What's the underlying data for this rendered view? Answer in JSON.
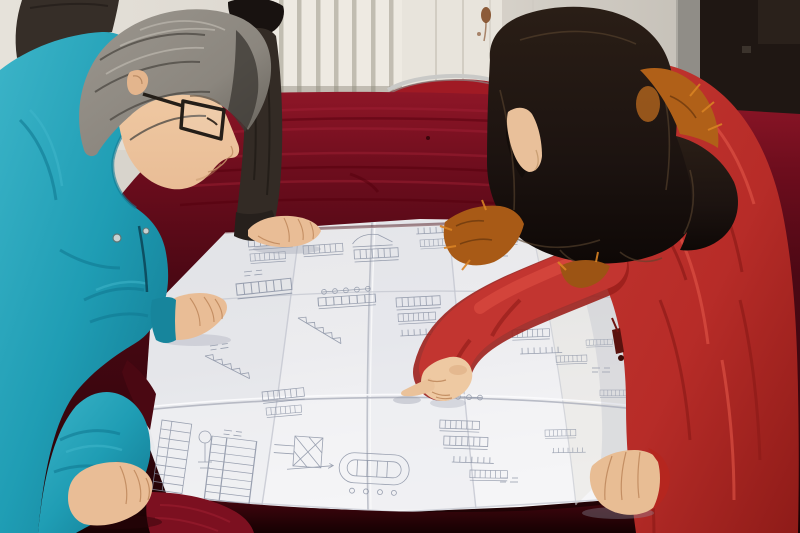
{
  "scene": {
    "type": "photograph",
    "alt": "Two workers lean over a large folded engineering blueprint spread on a dark crimson velvet-covered table. A gray-haired man in a teal work jacket and dark glasses studies the drawing from the left; a woman with long dark hair in a bright red parka with an orange fur-trimmed hood points at a detail. A third person in a dark jacket rests a hand on the far edge of the sheet.",
    "people": [
      {
        "label": "man in teal work jacket with glasses"
      },
      {
        "label": "person in dark jacket resting hand on drawing"
      },
      {
        "label": "woman in red fur-trimmed parka pointing at drawing"
      }
    ],
    "objects": [
      {
        "label": "folded blueprint technical drawing"
      },
      {
        "label": "crimson velvet table cover"
      },
      {
        "label": "white radiator"
      },
      {
        "label": "red chair with chrome frame"
      },
      {
        "label": "dark wooden door"
      }
    ]
  },
  "palette": {
    "wall_light": "#e6e2da",
    "wall_right": "#d6d1c9",
    "wall_right_dark": "#bdb8af",
    "radiator": "#eeeae2",
    "fin_shadow": "#b7b2a6",
    "door_dark": "#1f1713",
    "frame_strip": "#908d87",
    "stain_rust": "#7b431c",
    "chair_chrome": "#c9c9c7",
    "chair_seat": "#a01a24",
    "velvet_bright": "#8e1627",
    "velvet_mid": "#6d0d1d",
    "velvet_deep": "#3a060e",
    "velvet_dark": "#1a0203",
    "velvet_streak": "#a32136",
    "paper": "#ececef",
    "paper_bright": "#f6f6f8",
    "paper_shade": "#d9dce3",
    "drawing_line": "#8a92a4",
    "teal": "#1f9db4",
    "teal_dark": "#11768e",
    "teal_light": "#3cb4c8",
    "man_hair": "#8b867e",
    "man_hair_dark": "#514d47",
    "skin": "#e9bd96",
    "skin_shadow": "#c08a5e",
    "dark_jacket": "#362e28",
    "woman_hair": "#1c1310",
    "woman_hair_sheen": "#5a452f",
    "fur_orange": "#b06018",
    "fur_bright": "#d98324",
    "coat_red": "#c23530",
    "coat_shadow": "#8e1b18",
    "coat_highlight": "#e25648",
    "glasses_frame": "#241e18"
  }
}
